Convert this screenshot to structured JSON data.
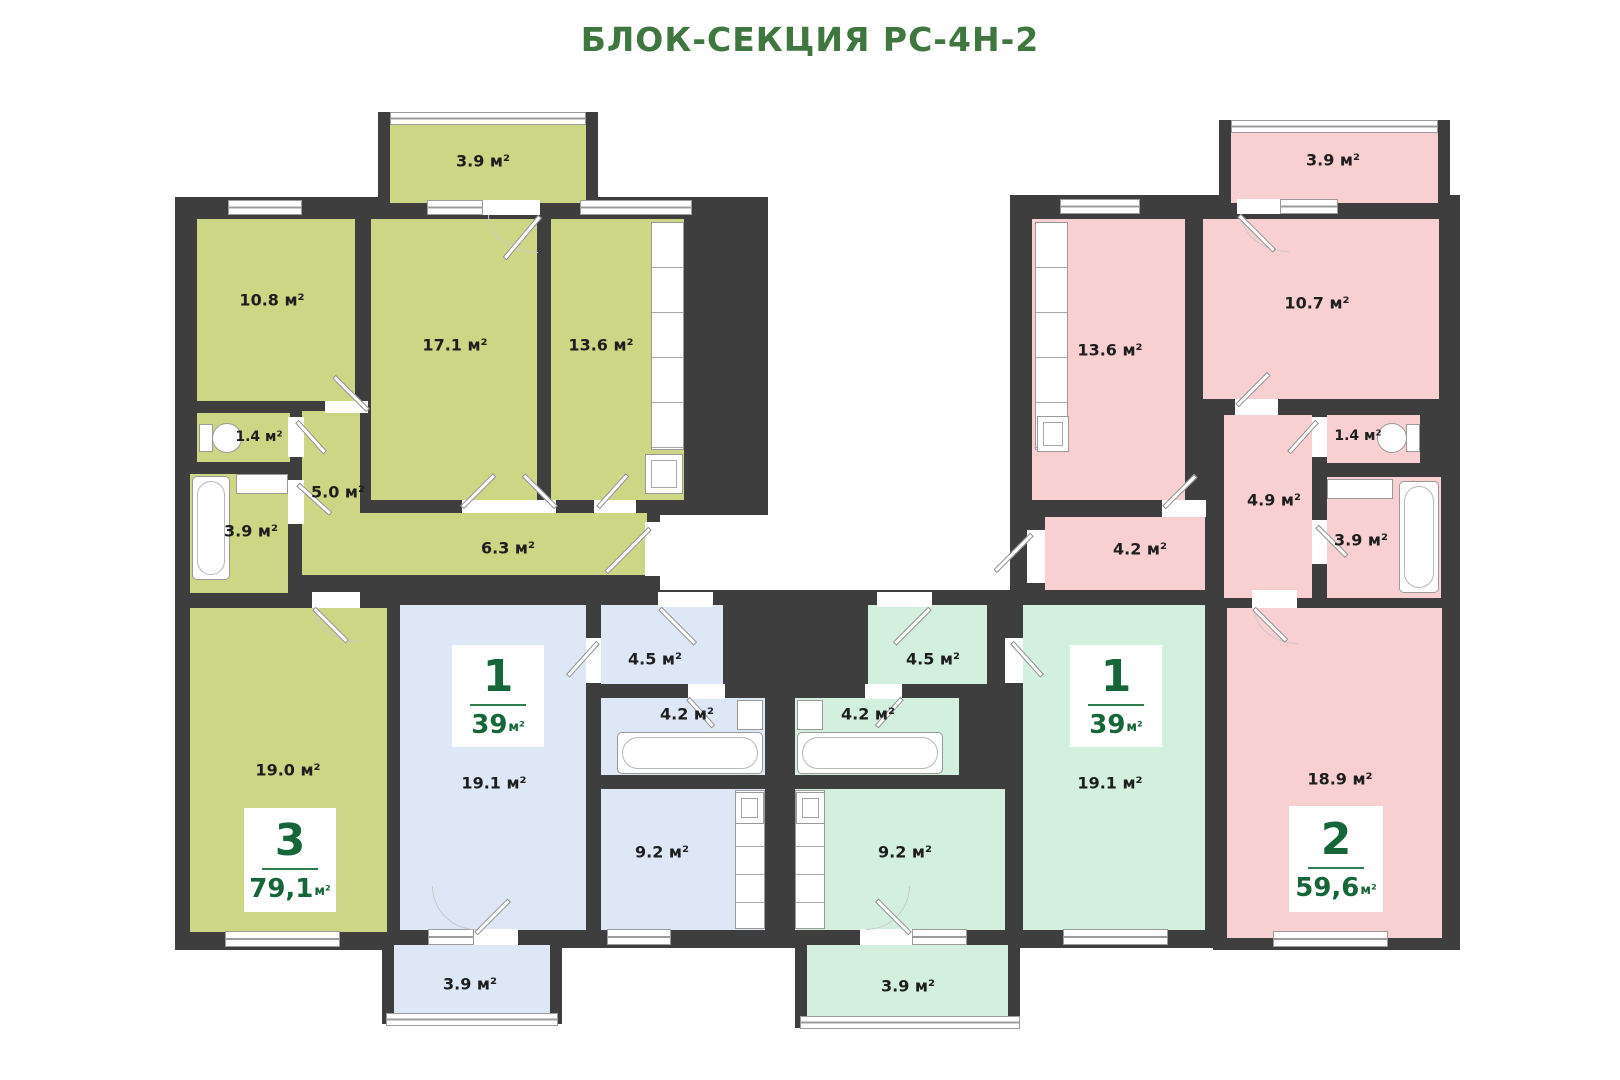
{
  "title": "БЛОК-СЕКЦИЯ РС-4Н-2",
  "colors": {
    "title_green": "#40763f",
    "badge_green": "#17663a",
    "wall_dark": "#3f3e3e",
    "apartment_3room_olive": "#ccd685",
    "apartment_1room_blue": "#dee7f6",
    "apartment_1room_mint": "#d3f0de",
    "apartment_2room_pink": "#f8d0d2"
  },
  "apartments": {
    "a3": {
      "badge": {
        "rooms": "3",
        "area": "79,1",
        "unit": "м²"
      },
      "rooms": {
        "balcony": "3.9 м²",
        "bed1": "10.8 м²",
        "living": "17.1 м²",
        "bed2": "13.6 м²",
        "wc": "1.4 м²",
        "hall": "5.0 м²",
        "bath": "3.9 м²",
        "corridor": "6.3 м²",
        "master": "19.0 м²"
      }
    },
    "b1": {
      "badge": {
        "rooms": "1",
        "area": "39",
        "unit": "м²"
      },
      "rooms": {
        "hall": "4.5 м²",
        "bath": "4.2 м²",
        "living": "19.1 м²",
        "kitchen": "9.2 м²",
        "balcony": "3.9 м²"
      }
    },
    "m1": {
      "badge": {
        "rooms": "1",
        "area": "39",
        "unit": "м²"
      },
      "rooms": {
        "hall": "4.5 м²",
        "bath": "4.2 м²",
        "living": "19.1 м²",
        "kitchen": "9.2 м²",
        "balcony": "3.9 м²"
      }
    },
    "p2": {
      "badge": {
        "rooms": "2",
        "area": "59,6",
        "unit": "м²"
      },
      "rooms": {
        "balcony": "3.9 м²",
        "bed1": "13.6 м²",
        "bed2": "10.7 м²",
        "wc": "1.4 м²",
        "hall": "4.9 м²",
        "corridor": "4.2 м²",
        "bath": "3.9 м²",
        "living": "18.9 м²"
      }
    }
  }
}
